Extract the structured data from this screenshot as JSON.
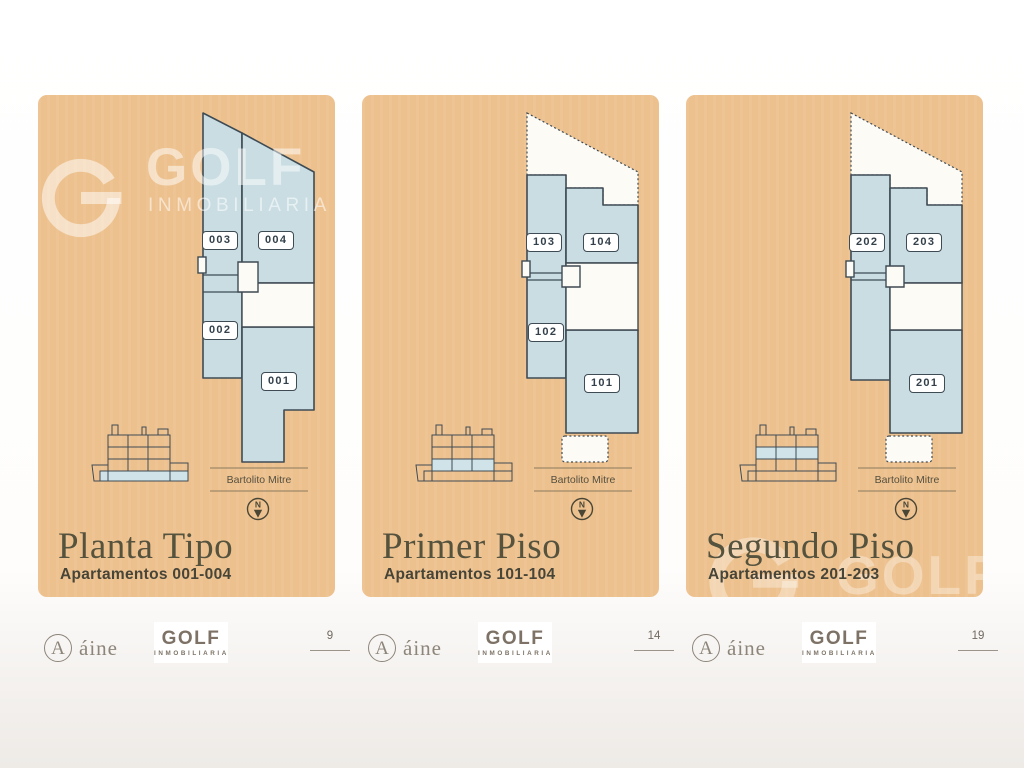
{
  "watermark": {
    "brand": "GOLF",
    "sub": "INMOBILIARIA"
  },
  "panels": [
    {
      "title": "Planta Tipo",
      "subtitle": "Apartamentos 001-004",
      "street": "Bartolito Mitre",
      "north": "N",
      "floor_highlight": "ground",
      "units": [
        "003",
        "004",
        "002",
        "001"
      ]
    },
    {
      "title": "Primer Piso",
      "subtitle": "Apartamentos 101-104",
      "street": "Bartolito Mitre",
      "north": "N",
      "floor_highlight": "first",
      "units": [
        "103",
        "104",
        "102",
        "101"
      ]
    },
    {
      "title": "Segundo Piso",
      "subtitle": "Apartamentos 201-203",
      "street": "Bartolito Mitre",
      "north": "N",
      "floor_highlight": "second",
      "units": [
        "202",
        "203",
        "201"
      ]
    }
  ],
  "footer": {
    "aine_initial": "A",
    "aine": "áine",
    "golf": "GOLF",
    "golf_sub": "INMOBILIARIA",
    "pages": [
      "9",
      "14",
      "19"
    ]
  },
  "colors": {
    "panel_bg": "#edc18e",
    "room_fill": "#c9dde3",
    "plan_outline": "#3e4b54",
    "plan_void": "#fdfbf6",
    "title_text": "#55523e",
    "footer_text": "#8d857a"
  }
}
